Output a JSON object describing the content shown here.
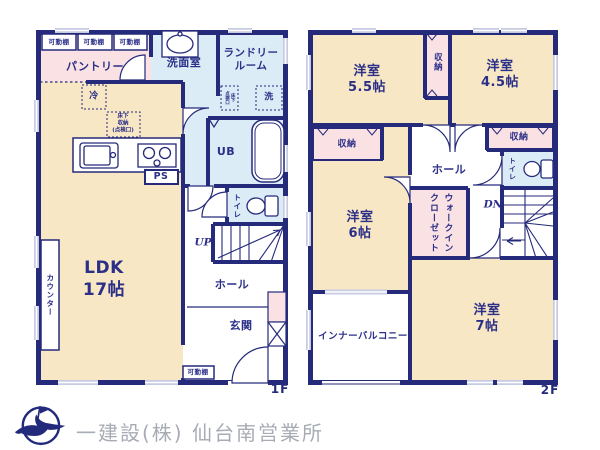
{
  "floors": {
    "f1": {
      "tag": "1F",
      "labels": {
        "shelf1": "可動棚",
        "shelf2": "可動棚",
        "shelf3": "可動棚",
        "pantry": "パントリー",
        "washroom": "洗面室",
        "laundry": "ランドリー\nルーム",
        "washer": "洗",
        "floor_hatch": "床下\n点検口",
        "unit_bath": "UB",
        "fridge": "冷",
        "underfloor_storage": "床下\n収納\n(点検口)",
        "pipe_space": "PS",
        "toilet": "トイレ",
        "stairs_up": "UP",
        "hall": "ホール",
        "entrance": "玄関",
        "shelf_entrance": "可動棚",
        "ldk": "LDK\n17帖",
        "counter": "カウンター"
      }
    },
    "f2": {
      "tag": "2F",
      "labels": {
        "room_55": "洋室\n5.5帖",
        "room_45": "洋室\n4.5帖",
        "closet_center": "収納",
        "closet_left": "収納",
        "closet_right": "収納",
        "hall": "ホール",
        "toilet": "トイレ",
        "room_6": "洋室\n6帖",
        "walk_in_closet": "ウォークイン\nクローゼット",
        "stairs_down": "DN",
        "room_7": "洋室\n7帖",
        "inner_balcony": "インナーバルコニー"
      }
    }
  },
  "footer": {
    "company": "一建設(株) 仙台南営業所"
  },
  "colors": {
    "wall": "#252a7b",
    "room_beige": "#f7e7c5",
    "room_pink": "#f9e1e4",
    "room_blue": "#dcecf7",
    "window": "#c7cbe2",
    "label_text": "#2b2f87",
    "footer_text": "#a7acb4"
  }
}
